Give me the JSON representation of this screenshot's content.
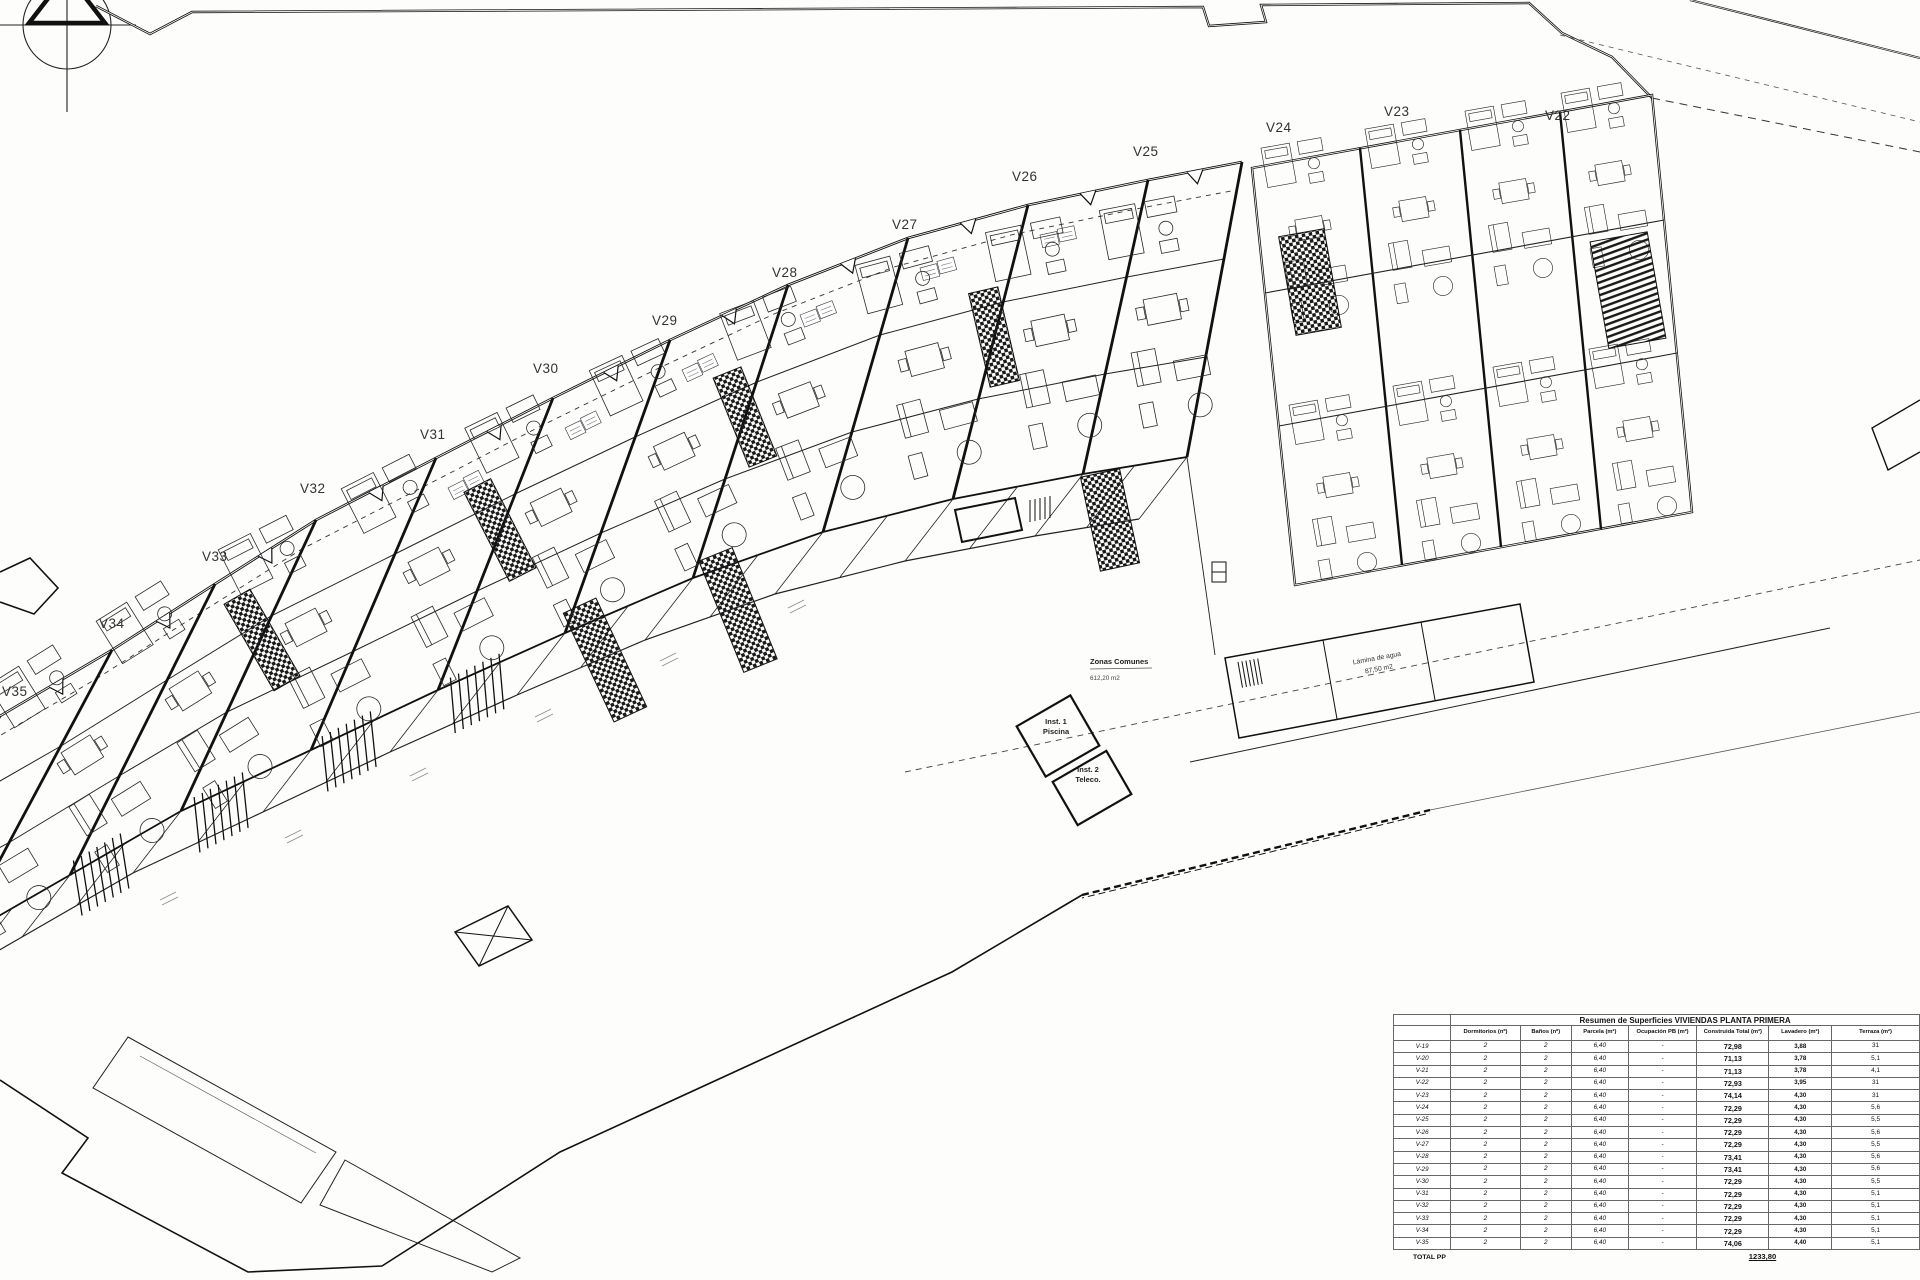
{
  "plan": {
    "unit_labels": [
      "V22",
      "V23",
      "V24",
      "V25",
      "V26",
      "V27",
      "V28",
      "V29",
      "V30",
      "V31",
      "V32",
      "V33",
      "V34",
      "V35"
    ],
    "annotations": {
      "zonas_title": "Zonas Comunes",
      "zonas_area": "612,20 m2",
      "lamina_1": "Lámina de agua",
      "lamina_2": "87,50 m2",
      "inst1_1": "Inst. 1",
      "inst1_2": "Piscina",
      "inst2_1": "Inst. 2",
      "inst2_2": "Teleco."
    }
  },
  "table": {
    "title": "Resumen de Superficies VIVIENDAS PLANTA PRIMERA",
    "columns": [
      "",
      "Dormitorios (nº)",
      "Baños (nº)",
      "Parcela (m²)",
      "Ocupación PB (m²)",
      "Construida Total (m²)",
      "Lavadero (m²)",
      "Terraza (m²)"
    ],
    "rows": [
      [
        "V-19",
        "2",
        "2",
        "6,40",
        "-",
        "72,98",
        "3,88",
        "31"
      ],
      [
        "V-20",
        "2",
        "2",
        "6,40",
        "-",
        "71,13",
        "3,78",
        "5,1"
      ],
      [
        "V-21",
        "2",
        "2",
        "6,40",
        "-",
        "71,13",
        "3,78",
        "4,1"
      ],
      [
        "V-22",
        "2",
        "2",
        "6,40",
        "-",
        "72,93",
        "3,95",
        "31"
      ],
      [
        "V-23",
        "2",
        "2",
        "6,40",
        "-",
        "74,14",
        "4,30",
        "31"
      ],
      [
        "V-24",
        "2",
        "2",
        "6,40",
        "-",
        "72,29",
        "4,30",
        "5,6"
      ],
      [
        "V-25",
        "2",
        "2",
        "6,40",
        "-",
        "72,29",
        "4,30",
        "5,5"
      ],
      [
        "V-26",
        "2",
        "2",
        "6,40",
        "-",
        "72,29",
        "4,30",
        "5,6"
      ],
      [
        "V-27",
        "2",
        "2",
        "6,40",
        "-",
        "72,29",
        "4,30",
        "5,5"
      ],
      [
        "V-28",
        "2",
        "2",
        "6,40",
        "-",
        "73,41",
        "4,30",
        "5,6"
      ],
      [
        "V-29",
        "2",
        "2",
        "6,40",
        "-",
        "73,41",
        "4,30",
        "5,6"
      ],
      [
        "V-30",
        "2",
        "2",
        "6,40",
        "-",
        "72,29",
        "4,30",
        "5,5"
      ],
      [
        "V-31",
        "2",
        "2",
        "6,40",
        "-",
        "72,29",
        "4,30",
        "5,1"
      ],
      [
        "V-32",
        "2",
        "2",
        "6,40",
        "-",
        "72,29",
        "4,30",
        "5,1"
      ],
      [
        "V-33",
        "2",
        "2",
        "6,40",
        "-",
        "72,29",
        "4,30",
        "5,1"
      ],
      [
        "V-34",
        "2",
        "2",
        "6,40",
        "-",
        "72,29",
        "4,30",
        "5,1"
      ],
      [
        "V-35",
        "2",
        "2",
        "6,40",
        "-",
        "74,06",
        "4,40",
        "5,1"
      ]
    ],
    "total_label": "TOTAL PP",
    "total_value": "1233,80"
  }
}
